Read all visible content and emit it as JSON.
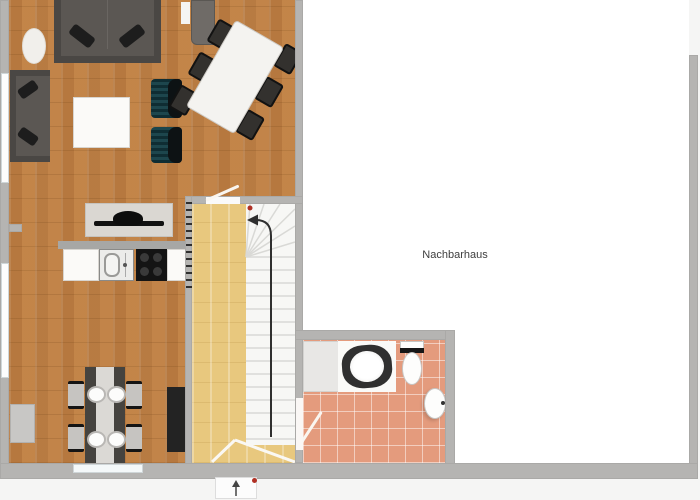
{
  "labels": {
    "neighbor_house": "Nachbarhaus"
  },
  "icons": {
    "stair_direction": "curved-arrow-up-left",
    "entrance_direction": "arrow-up"
  },
  "colors": {
    "background": "#f5f5f4",
    "wood": "#c28449",
    "stair_wood": "#e8c87e",
    "tile": "#e49b7d",
    "wall": "#b5b4b2",
    "neighbor_floor": "#ffffff",
    "stairs_white": "#f7f7f5",
    "sofa": "#5b5753",
    "armchair": "#1d464d",
    "dark_furniture": "#232323",
    "arrow": "#2f2f2f",
    "red_marker": "#b03024"
  }
}
